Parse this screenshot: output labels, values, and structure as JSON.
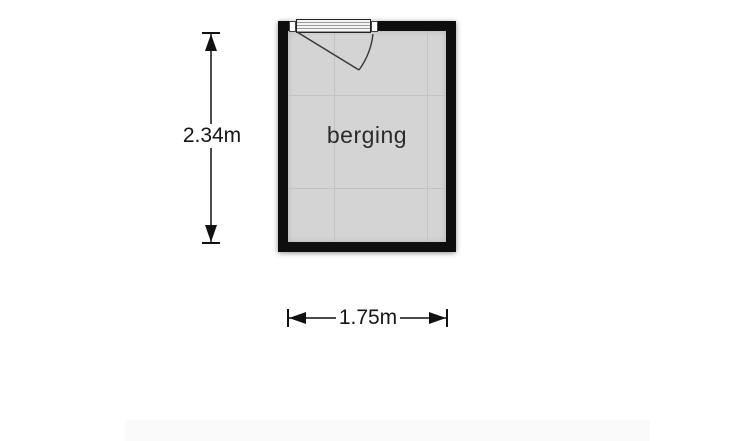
{
  "floorplan": {
    "room": {
      "label": "berging"
    },
    "dimensions": {
      "height_label": "2.34m",
      "width_label": "1.75m"
    },
    "door": {
      "type": "hinged-door",
      "wall": "top",
      "hinge_side": "left"
    },
    "colors": {
      "wall": "#0e0e0e",
      "floor": "#d4d4d4",
      "grid_line": "#c3c3c3",
      "background": "#ffffff",
      "dimension_text": "#151515"
    }
  }
}
